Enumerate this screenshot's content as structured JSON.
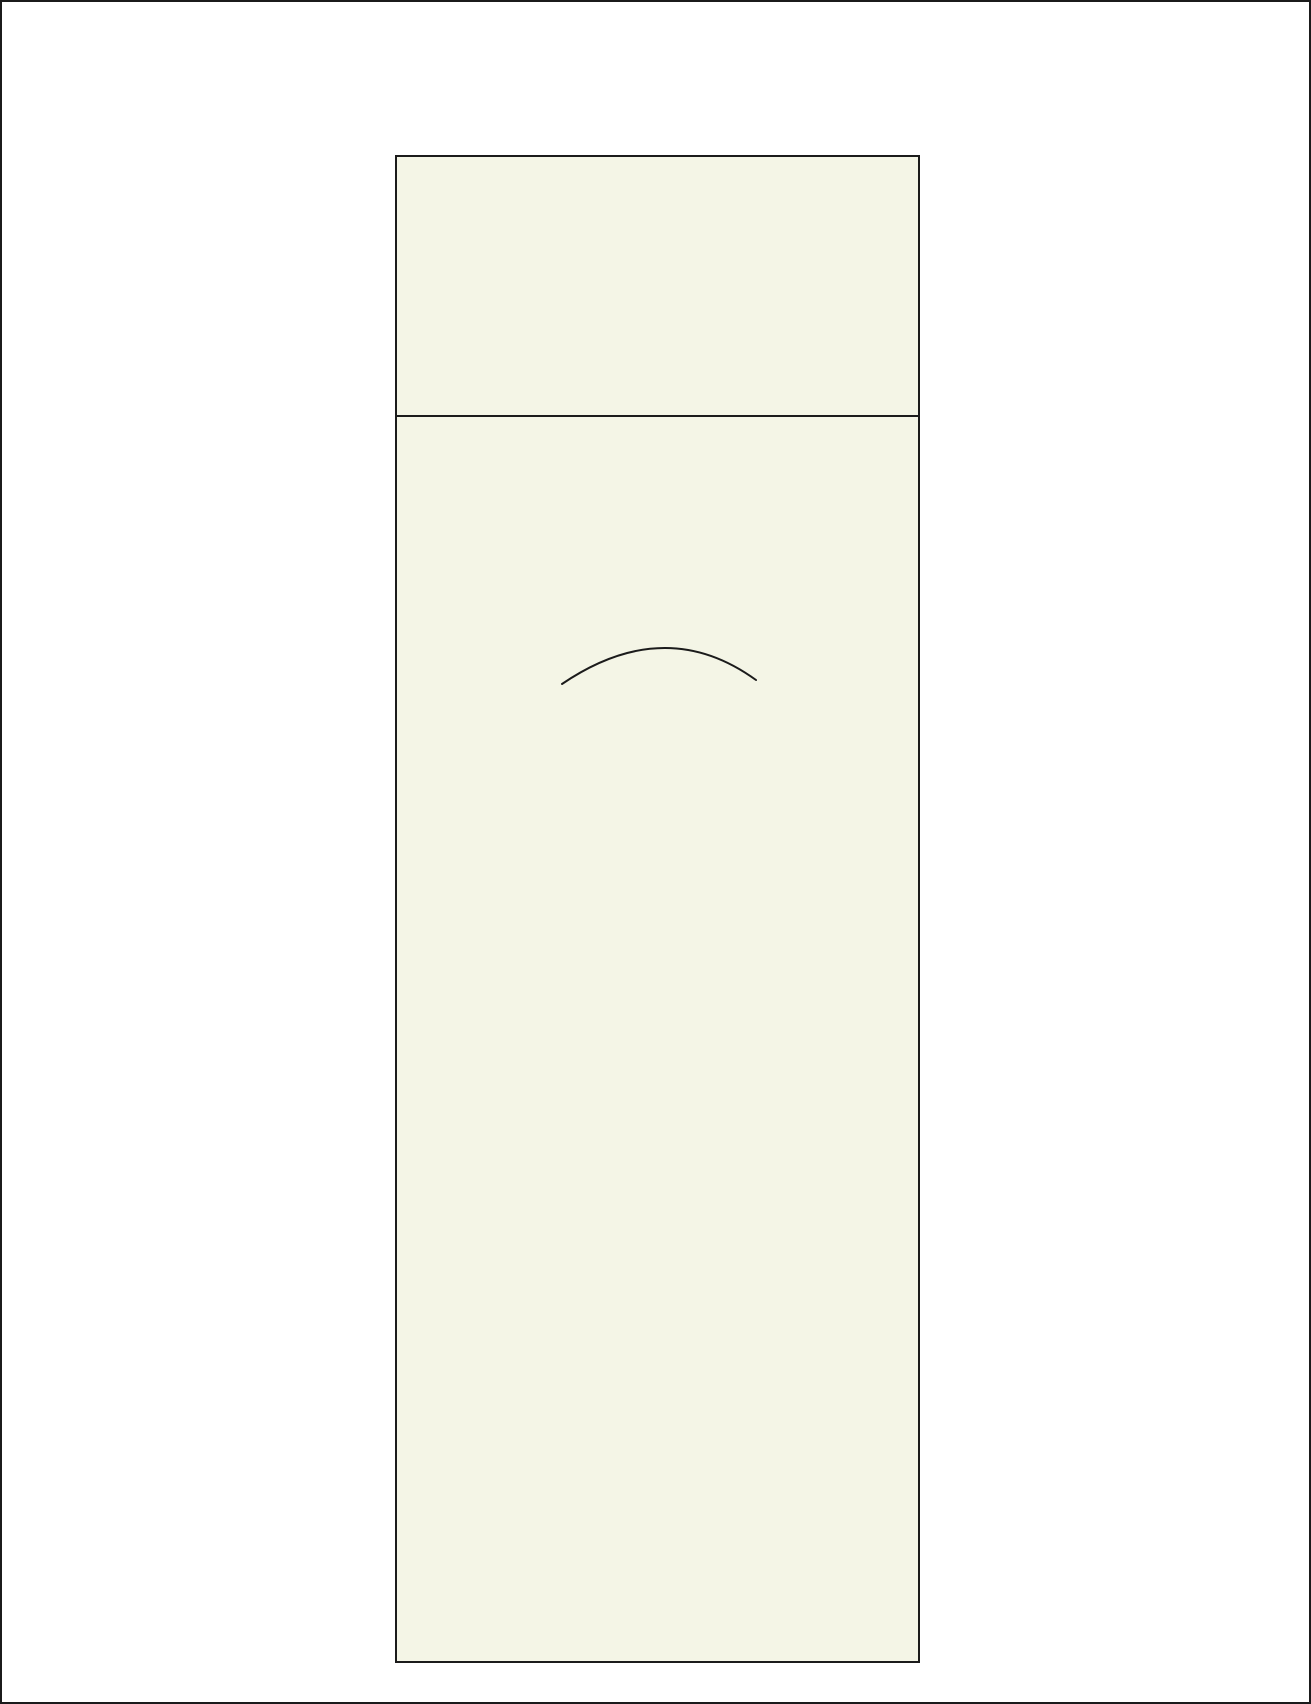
{
  "description": {
    "summary": "Blank drawing page: white sheet with black outer frame, a tall ivory panel outlined in black with a horizontal header divider, and a single shallow concave-down arc in the upper middle of the panel body. No text anywhere.",
    "text_content": ""
  },
  "colors": {
    "page_bg": "#ffffff",
    "ink": "#1b1b1b",
    "panel_fill": "#f4f5e6"
  },
  "shapes": {
    "outer_frame": {
      "type": "rect-border",
      "stroke": "#1b1b1b",
      "stroke_width": 2
    },
    "panel": {
      "type": "rect",
      "fill": "#f4f5e6",
      "stroke": "#1b1b1b",
      "stroke_width": 2,
      "divider_note": "horizontal rule separating empty header band from empty body"
    }
  },
  "arc": {
    "type": "curve",
    "path": "M 560 682 Q 663 612 754 678",
    "stroke": "#1b1b1b",
    "stroke_width": "2"
  }
}
